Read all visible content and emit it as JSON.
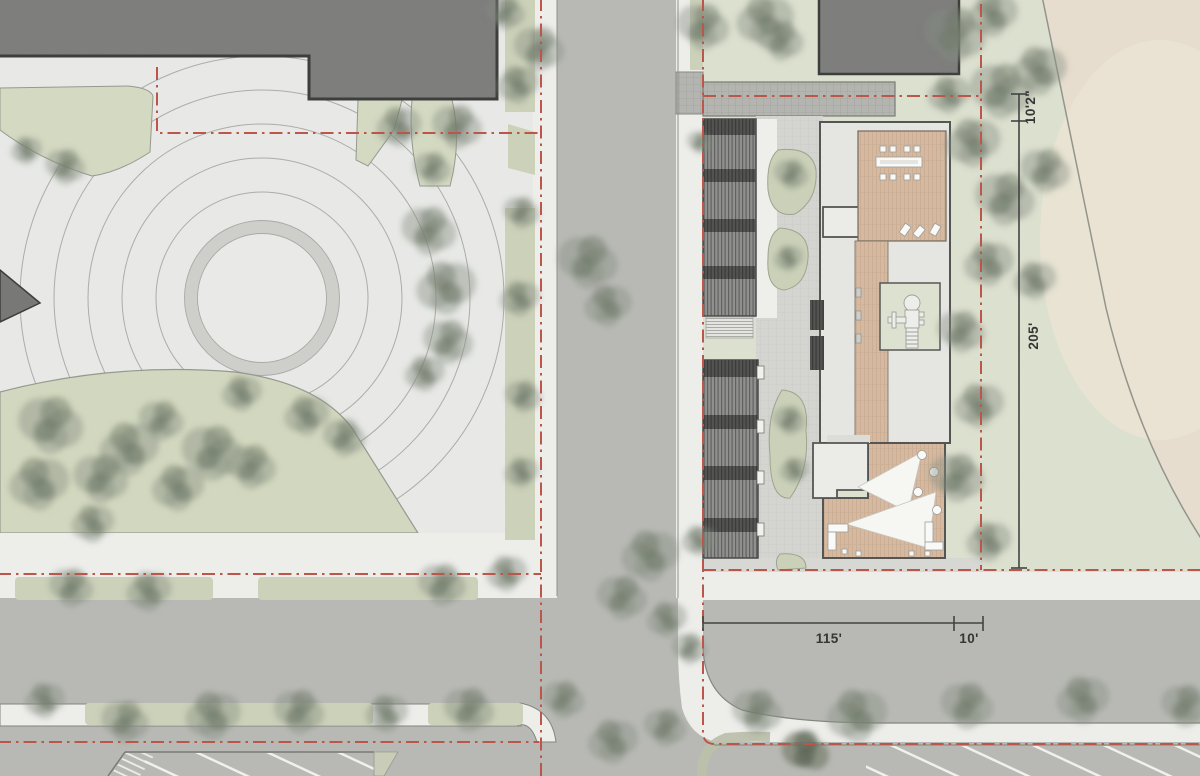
{
  "dimensions": {
    "side_upper": "10'2\"",
    "side_main": "205'",
    "bottom_main": "115'",
    "bottom_corner": "10'"
  },
  "palette": {
    "paper": "#ecedeb",
    "road_asphalt": "#b7b8b4",
    "sidewalk": "#f2f2f0",
    "lawn_left": "#d6dcc3",
    "lawn_site": "#dfe3d1",
    "field_tan": "#ebe0d0",
    "tree_wash": "#7e887a",
    "tree_dark": "#4d584a",
    "existing_building_gray": "#757575",
    "building_outline": "#2d2d2d",
    "roof_light": "#e9e9e7",
    "deck_wood": "#d7b89e",
    "louver_roof": "#8a8a8a",
    "property_line_red": "#b94a3c",
    "dimension_ink": "#333333"
  }
}
